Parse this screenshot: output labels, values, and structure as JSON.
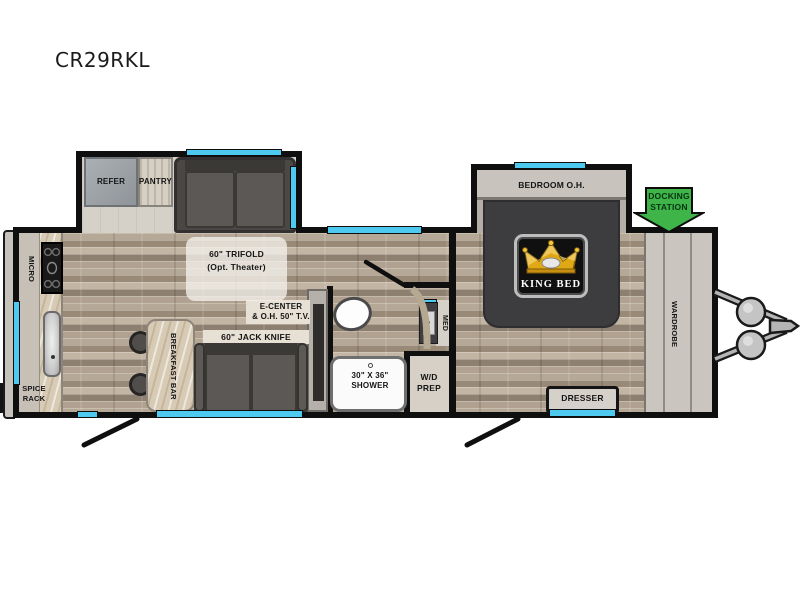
{
  "title": "CR29RKL",
  "labels": {
    "refer": "REFER",
    "pantry": "PANTRY",
    "trifold1": "60\" TRIFOLD",
    "trifold2": "(Opt. Theater)",
    "micro": "MICRO",
    "spice1": "SPICE",
    "spice2": "RACK",
    "ecenter1": "E-CENTER",
    "ecenter2": "& O.H. 50\" T.V.",
    "jack_knife": "60\" JACK KNIFE",
    "breakfast_bar": "BREAKFAST BAR",
    "shower1": "30\" X 36\"",
    "shower2": "SHOWER",
    "wd1": "W/D",
    "wd2": "PREP",
    "med": "MED",
    "bedroom_oh": "BEDROOM O.H.",
    "king_bed": "KING BED",
    "docking1": "DOCKING",
    "docking2": "STATION",
    "wardrobe": "WARDROBE",
    "dresser": "DRESSER"
  },
  "colors": {
    "window": "#4ec9f0",
    "wall": "#0f0f0f",
    "docking": "#3eb449",
    "bed": "#3d3d3f",
    "gold": "#e0a815"
  }
}
